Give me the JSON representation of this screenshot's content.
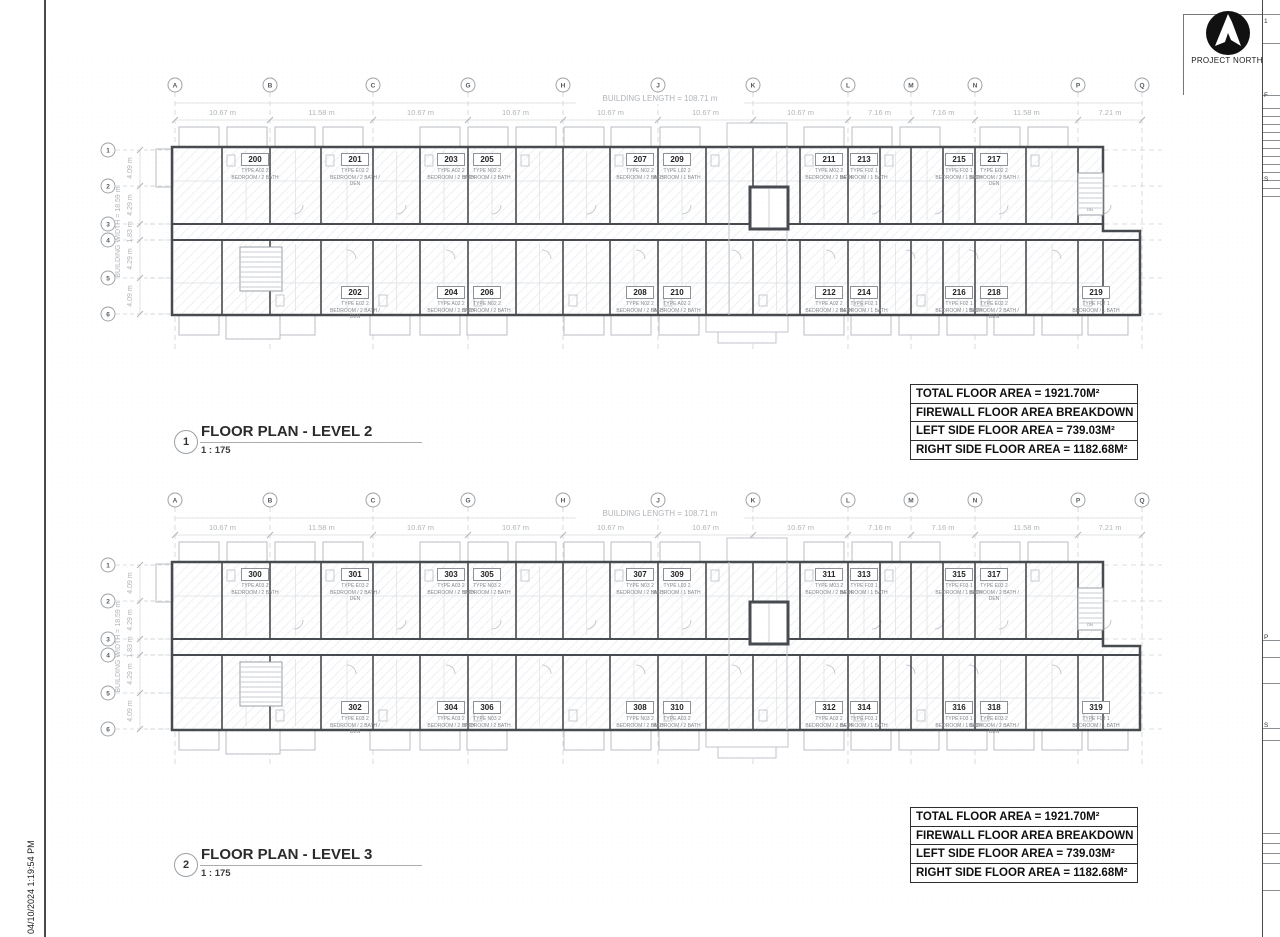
{
  "sheet": {
    "date_stamp": "04/10/2024 1:19:54 PM",
    "stair_label": "DN"
  },
  "logo": {
    "label": "PROJECT NORTH"
  },
  "grid": {
    "building_length_label": "BUILDING LENGTH = 108.71 m",
    "building_width_label": "BUILDING WIDTH = 18.59 m",
    "columns": [
      {
        "label": "A",
        "x": 175
      },
      {
        "label": "B",
        "x": 270
      },
      {
        "label": "C",
        "x": 373
      },
      {
        "label": "G",
        "x": 468
      },
      {
        "label": "H",
        "x": 563
      },
      {
        "label": "J",
        "x": 658
      },
      {
        "label": "K",
        "x": 753
      },
      {
        "label": "L",
        "x": 848
      },
      {
        "label": "M",
        "x": 911
      },
      {
        "label": "N",
        "x": 975
      },
      {
        "label": "P",
        "x": 1078
      },
      {
        "label": "Q",
        "x": 1142
      }
    ],
    "column_dims": [
      "10.67 m",
      "11.58 m",
      "10.67 m",
      "10.67 m",
      "10.67 m",
      "10.67 m",
      "10.67 m",
      "7.16 m",
      "7.16 m",
      "11.58 m",
      "7.21 m"
    ],
    "rows": [
      {
        "label": "1",
        "y": 65
      },
      {
        "label": "2",
        "y": 101
      },
      {
        "label": "3",
        "y": 139
      },
      {
        "label": "4",
        "y": 155
      },
      {
        "label": "5",
        "y": 193
      },
      {
        "label": "6",
        "y": 229
      }
    ],
    "row_dims": [
      "4.09 m",
      "4.29 m",
      "1.83 m",
      "4.29 m",
      "4.09 m"
    ]
  },
  "levels": [
    {
      "figure_number": "1",
      "title": "FLOOR PLAN - LEVEL 2",
      "scale": "1 : 175",
      "area_table": [
        "TOTAL FLOOR AREA = 1921.70M²",
        "FIREWALL FLOOR AREA BREAKDOWN",
        "LEFT SIDE FLOOR AREA = 739.03M²",
        "RIGHT SIDE FLOOR AREA = 1182.68M²"
      ],
      "units": [
        {
          "number": "200",
          "type": "TYPE A02",
          "desc": "2 BEDROOM / 2 BATH",
          "x": 255,
          "row": "top"
        },
        {
          "number": "201",
          "type": "TYPE E02",
          "desc": "2 BEDROOM / 2 BATH / DEN",
          "x": 355,
          "row": "top"
        },
        {
          "number": "203",
          "type": "TYPE A02",
          "desc": "2 BEDROOM / 2 BATH",
          "x": 451,
          "row": "top"
        },
        {
          "number": "205",
          "type": "TYPE N02",
          "desc": "2 BEDROOM / 2 BATH",
          "x": 487,
          "row": "top"
        },
        {
          "number": "207",
          "type": "TYPE N02",
          "desc": "2 BEDROOM / 2 BATH",
          "x": 640,
          "row": "top"
        },
        {
          "number": "209",
          "type": "TYPE L02",
          "desc": "2 BEDROOM / 1 BATH",
          "x": 677,
          "row": "top"
        },
        {
          "number": "211",
          "type": "TYPE M02",
          "desc": "2 BEDROOM / 2 BATH",
          "x": 829,
          "row": "top"
        },
        {
          "number": "213",
          "type": "TYPE F02",
          "desc": "1 BEDROOM / 1 BATH",
          "x": 864,
          "row": "top"
        },
        {
          "number": "215",
          "type": "TYPE F02",
          "desc": "1 BEDROOM / 1 BATH",
          "x": 959,
          "row": "top"
        },
        {
          "number": "217",
          "type": "TYPE E02",
          "desc": "2 BEDROOM / 2 BATH / DEN",
          "x": 994,
          "row": "top"
        },
        {
          "number": "202",
          "type": "TYPE E02",
          "desc": "2 BEDROOM / 2 BATH / DEN",
          "x": 355,
          "row": "bottom"
        },
        {
          "number": "204",
          "type": "TYPE A02",
          "desc": "2 BEDROOM / 2 BATH",
          "x": 451,
          "row": "bottom"
        },
        {
          "number": "206",
          "type": "TYPE N02",
          "desc": "2 BEDROOM / 2 BATH",
          "x": 487,
          "row": "bottom"
        },
        {
          "number": "208",
          "type": "TYPE N02",
          "desc": "2 BEDROOM / 2 BATH",
          "x": 640,
          "row": "bottom"
        },
        {
          "number": "210",
          "type": "TYPE A02",
          "desc": "2 BEDROOM / 2 BATH",
          "x": 677,
          "row": "bottom"
        },
        {
          "number": "212",
          "type": "TYPE A02",
          "desc": "2 BEDROOM / 2 BATH",
          "x": 829,
          "row": "bottom"
        },
        {
          "number": "214",
          "type": "TYPE F02",
          "desc": "1 BEDROOM / 1 BATH",
          "x": 864,
          "row": "bottom"
        },
        {
          "number": "216",
          "type": "TYPE F02",
          "desc": "1 BEDROOM / 1 BATH",
          "x": 959,
          "row": "bottom"
        },
        {
          "number": "218",
          "type": "TYPE E02",
          "desc": "2 BEDROOM / 2 BATH / DEN",
          "x": 994,
          "row": "bottom"
        },
        {
          "number": "219",
          "type": "TYPE F02",
          "desc": "1 BEDROOM / 1 BATH",
          "x": 1096,
          "row": "bottom"
        }
      ]
    },
    {
      "figure_number": "2",
      "title": "FLOOR PLAN - LEVEL 3",
      "scale": "1 : 175",
      "area_table": [
        "TOTAL FLOOR AREA = 1921.70M²",
        "FIREWALL FLOOR AREA BREAKDOWN",
        "LEFT SIDE FLOOR AREA = 739.03M²",
        "RIGHT SIDE FLOOR AREA = 1182.68M²"
      ],
      "units": [
        {
          "number": "300",
          "type": "TYPE A03",
          "desc": "2 BEDROOM / 2 BATH",
          "x": 255,
          "row": "top"
        },
        {
          "number": "301",
          "type": "TYPE E03",
          "desc": "2 BEDROOM / 2 BATH / DEN",
          "x": 355,
          "row": "top"
        },
        {
          "number": "303",
          "type": "TYPE A03",
          "desc": "2 BEDROOM / 2 BATH",
          "x": 451,
          "row": "top"
        },
        {
          "number": "305",
          "type": "TYPE N03",
          "desc": "2 BEDROOM / 2 BATH",
          "x": 487,
          "row": "top"
        },
        {
          "number": "307",
          "type": "TYPE N03",
          "desc": "2 BEDROOM / 2 BATH",
          "x": 640,
          "row": "top"
        },
        {
          "number": "309",
          "type": "TYPE L03",
          "desc": "2 BEDROOM / 1 BATH",
          "x": 677,
          "row": "top"
        },
        {
          "number": "311",
          "type": "TYPE M03",
          "desc": "2 BEDROOM / 2 BATH",
          "x": 829,
          "row": "top"
        },
        {
          "number": "313",
          "type": "TYPE F03",
          "desc": "1 BEDROOM / 1 BATH",
          "x": 864,
          "row": "top"
        },
        {
          "number": "315",
          "type": "TYPE F03",
          "desc": "1 BEDROOM / 1 BATH",
          "x": 959,
          "row": "top"
        },
        {
          "number": "317",
          "type": "TYPE E03",
          "desc": "2 BEDROOM / 2 BATH / DEN",
          "x": 994,
          "row": "top"
        },
        {
          "number": "302",
          "type": "TYPE E03",
          "desc": "2 BEDROOM / 2 BATH / DEN",
          "x": 355,
          "row": "bottom"
        },
        {
          "number": "304",
          "type": "TYPE A03",
          "desc": "2 BEDROOM / 2 BATH",
          "x": 451,
          "row": "bottom"
        },
        {
          "number": "306",
          "type": "TYPE N03",
          "desc": "2 BEDROOM / 2 BATH",
          "x": 487,
          "row": "bottom"
        },
        {
          "number": "308",
          "type": "TYPE N03",
          "desc": "2 BEDROOM / 2 BATH",
          "x": 640,
          "row": "bottom"
        },
        {
          "number": "310",
          "type": "TYPE A03",
          "desc": "2 BEDROOM / 2 BATH",
          "x": 677,
          "row": "bottom"
        },
        {
          "number": "312",
          "type": "TYPE A03",
          "desc": "2 BEDROOM / 2 BATH",
          "x": 829,
          "row": "bottom"
        },
        {
          "number": "314",
          "type": "TYPE F03",
          "desc": "1 BEDROOM / 1 BATH",
          "x": 864,
          "row": "bottom"
        },
        {
          "number": "316",
          "type": "TYPE F03",
          "desc": "1 BEDROOM / 1 BATH",
          "x": 959,
          "row": "bottom"
        },
        {
          "number": "318",
          "type": "TYPE E03",
          "desc": "2 BEDROOM / 2 BATH / DEN",
          "x": 994,
          "row": "bottom"
        },
        {
          "number": "319",
          "type": "TYPE F03",
          "desc": "1 BEDROOM / 1 BATH",
          "x": 1096,
          "row": "bottom"
        }
      ]
    }
  ],
  "right_strip_fragments": [
    {
      "text": "1",
      "y": 18
    },
    {
      "text": "F",
      "y": 92
    },
    {
      "text": "S",
      "y": 176
    },
    {
      "text": "P",
      "y": 634
    },
    {
      "text": "S",
      "y": 722
    }
  ]
}
